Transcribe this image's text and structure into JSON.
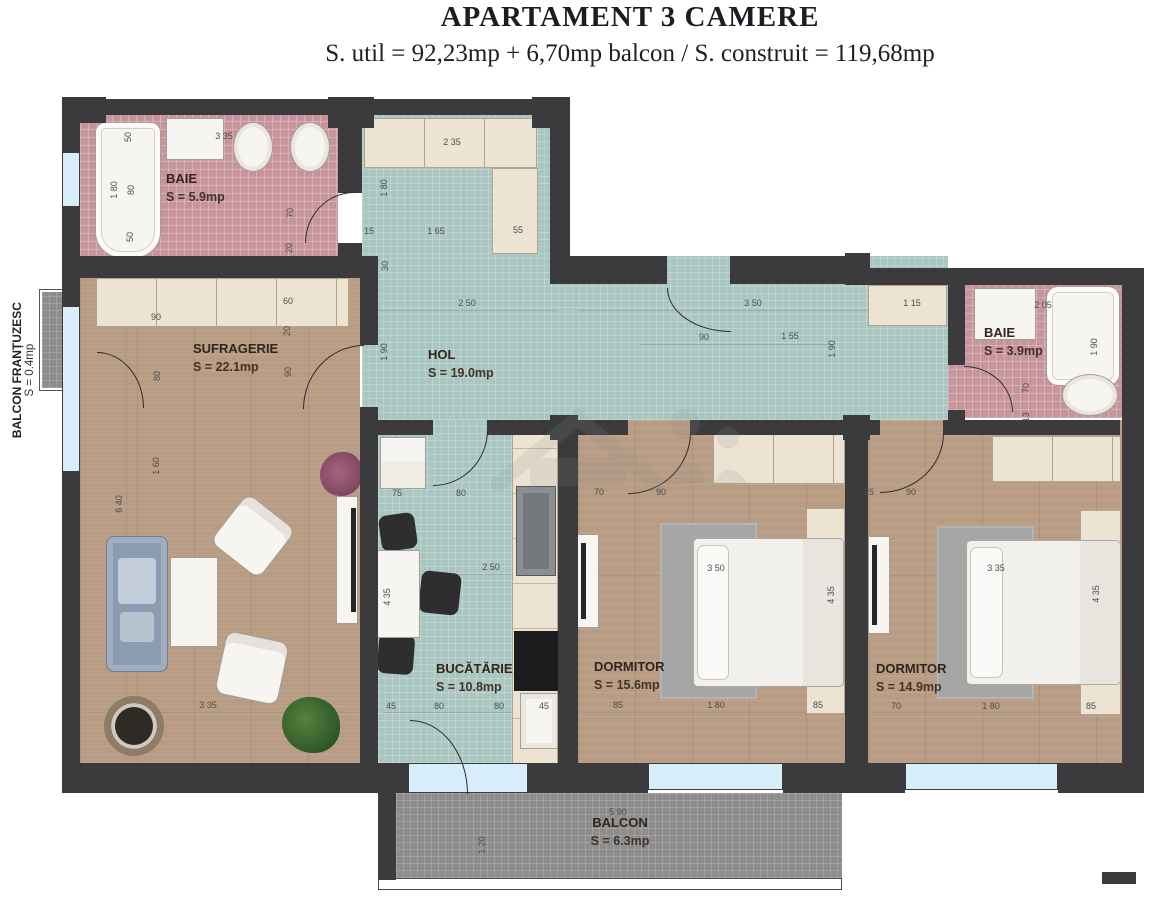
{
  "header": {
    "title": "APARTAMENT 3 CAMERE",
    "subtitle": "S. util = 92,23mp + 6,70mp balcon / S. construit = 119,68mp"
  },
  "rooms": {
    "baie1": {
      "name": "BAIE",
      "area": "S = 5.9mp"
    },
    "sufragerie": {
      "name": "SUFRAGERIE",
      "area": "S = 22.1mp"
    },
    "hol": {
      "name": "HOL",
      "area": "S = 19.0mp"
    },
    "baie2": {
      "name": "BAIE",
      "area": "S = 3.9mp"
    },
    "bucatarie": {
      "name": "BUCĂTĂRIE",
      "area": "S = 10.8mp"
    },
    "dormitor1": {
      "name": "DORMITOR",
      "area": "S = 15.6mp"
    },
    "dormitor2": {
      "name": "DORMITOR",
      "area": "S = 14.9mp"
    },
    "balcon": {
      "name": "BALCON",
      "area": "S = 6.3mp"
    },
    "balcon_frantuzesc": {
      "name": "BALCON FRANȚUZESC",
      "area": "S = 0.4mp"
    }
  },
  "colors": {
    "wall": "#3b3b3d",
    "wood_floor": "#b89c83",
    "tile_teal": "#a9c6c1",
    "tile_pink": "#c6949a",
    "balcony_gray": "#8d8d8d",
    "window_blue": "#d7edf9"
  },
  "dimensions": [
    {
      "t": "50",
      "x": 128,
      "y": 137,
      "o": "v"
    },
    {
      "t": "3 35",
      "x": 224,
      "y": 136,
      "o": "h"
    },
    {
      "t": "1 80",
      "x": 114,
      "y": 190,
      "o": "v"
    },
    {
      "t": "80",
      "x": 131,
      "y": 190,
      "o": "v"
    },
    {
      "t": "50",
      "x": 130,
      "y": 237,
      "o": "v"
    },
    {
      "t": "70",
      "x": 290,
      "y": 213,
      "o": "v"
    },
    {
      "t": "20",
      "x": 289,
      "y": 248,
      "o": "v"
    },
    {
      "t": "2 35",
      "x": 452,
      "y": 142,
      "o": "h"
    },
    {
      "t": "1 80",
      "x": 384,
      "y": 188,
      "o": "v"
    },
    {
      "t": "15",
      "x": 369,
      "y": 231,
      "o": "h"
    },
    {
      "t": "1 65",
      "x": 436,
      "y": 231,
      "o": "h"
    },
    {
      "t": "55",
      "x": 518,
      "y": 230,
      "o": "h"
    },
    {
      "t": "30",
      "x": 385,
      "y": 266,
      "o": "v"
    },
    {
      "t": "2 50",
      "x": 467,
      "y": 303,
      "o": "h"
    },
    {
      "t": "3 50",
      "x": 753,
      "y": 303,
      "o": "h"
    },
    {
      "t": "1 90",
      "x": 384,
      "y": 352,
      "o": "v"
    },
    {
      "t": "90",
      "x": 704,
      "y": 337,
      "o": "h"
    },
    {
      "t": "1 55",
      "x": 790,
      "y": 336,
      "o": "h"
    },
    {
      "t": "1 90",
      "x": 832,
      "y": 349,
      "o": "v"
    },
    {
      "t": "1 15",
      "x": 912,
      "y": 303,
      "o": "h"
    },
    {
      "t": "2 05",
      "x": 1043,
      "y": 305,
      "o": "h"
    },
    {
      "t": "1 90",
      "x": 1094,
      "y": 347,
      "o": "v"
    },
    {
      "t": "70",
      "x": 1026,
      "y": 388,
      "o": "v"
    },
    {
      "t": "13",
      "x": 1026,
      "y": 417,
      "o": "v"
    },
    {
      "t": "90",
      "x": 156,
      "y": 317,
      "o": "h"
    },
    {
      "t": "60",
      "x": 288,
      "y": 301,
      "o": "h"
    },
    {
      "t": "20",
      "x": 287,
      "y": 331,
      "o": "v"
    },
    {
      "t": "80",
      "x": 157,
      "y": 376,
      "o": "v"
    },
    {
      "t": "90",
      "x": 288,
      "y": 372,
      "o": "v"
    },
    {
      "t": "1 60",
      "x": 156,
      "y": 466,
      "o": "v"
    },
    {
      "t": "6 40",
      "x": 119,
      "y": 504,
      "o": "v"
    },
    {
      "t": "3 35",
      "x": 208,
      "y": 705,
      "o": "h"
    },
    {
      "t": "75",
      "x": 397,
      "y": 493,
      "o": "h"
    },
    {
      "t": "80",
      "x": 461,
      "y": 493,
      "o": "h"
    },
    {
      "t": "2 50",
      "x": 491,
      "y": 567,
      "o": "h"
    },
    {
      "t": "4 35",
      "x": 387,
      "y": 597,
      "o": "v"
    },
    {
      "t": "45",
      "x": 391,
      "y": 706,
      "o": "h"
    },
    {
      "t": "80",
      "x": 439,
      "y": 706,
      "o": "h"
    },
    {
      "t": "80",
      "x": 499,
      "y": 706,
      "o": "h"
    },
    {
      "t": "45",
      "x": 544,
      "y": 706,
      "o": "h"
    },
    {
      "t": "70",
      "x": 599,
      "y": 492,
      "o": "h"
    },
    {
      "t": "90",
      "x": 661,
      "y": 492,
      "o": "h"
    },
    {
      "t": "3 50",
      "x": 716,
      "y": 568,
      "o": "h"
    },
    {
      "t": "4 35",
      "x": 831,
      "y": 595,
      "o": "v"
    },
    {
      "t": "85",
      "x": 618,
      "y": 705,
      "o": "h"
    },
    {
      "t": "1 80",
      "x": 716,
      "y": 705,
      "o": "h"
    },
    {
      "t": "85",
      "x": 818,
      "y": 705,
      "o": "h"
    },
    {
      "t": "25",
      "x": 869,
      "y": 492,
      "o": "h"
    },
    {
      "t": "90",
      "x": 911,
      "y": 492,
      "o": "h"
    },
    {
      "t": "3 35",
      "x": 996,
      "y": 568,
      "o": "h"
    },
    {
      "t": "4 35",
      "x": 1096,
      "y": 594,
      "o": "v"
    },
    {
      "t": "70",
      "x": 896,
      "y": 706,
      "o": "h"
    },
    {
      "t": "1 80",
      "x": 991,
      "y": 706,
      "o": "h"
    },
    {
      "t": "85",
      "x": 1091,
      "y": 706,
      "o": "h"
    },
    {
      "t": "5 90",
      "x": 618,
      "y": 812,
      "o": "h"
    },
    {
      "t": "1 20",
      "x": 482,
      "y": 845,
      "o": "v"
    }
  ]
}
